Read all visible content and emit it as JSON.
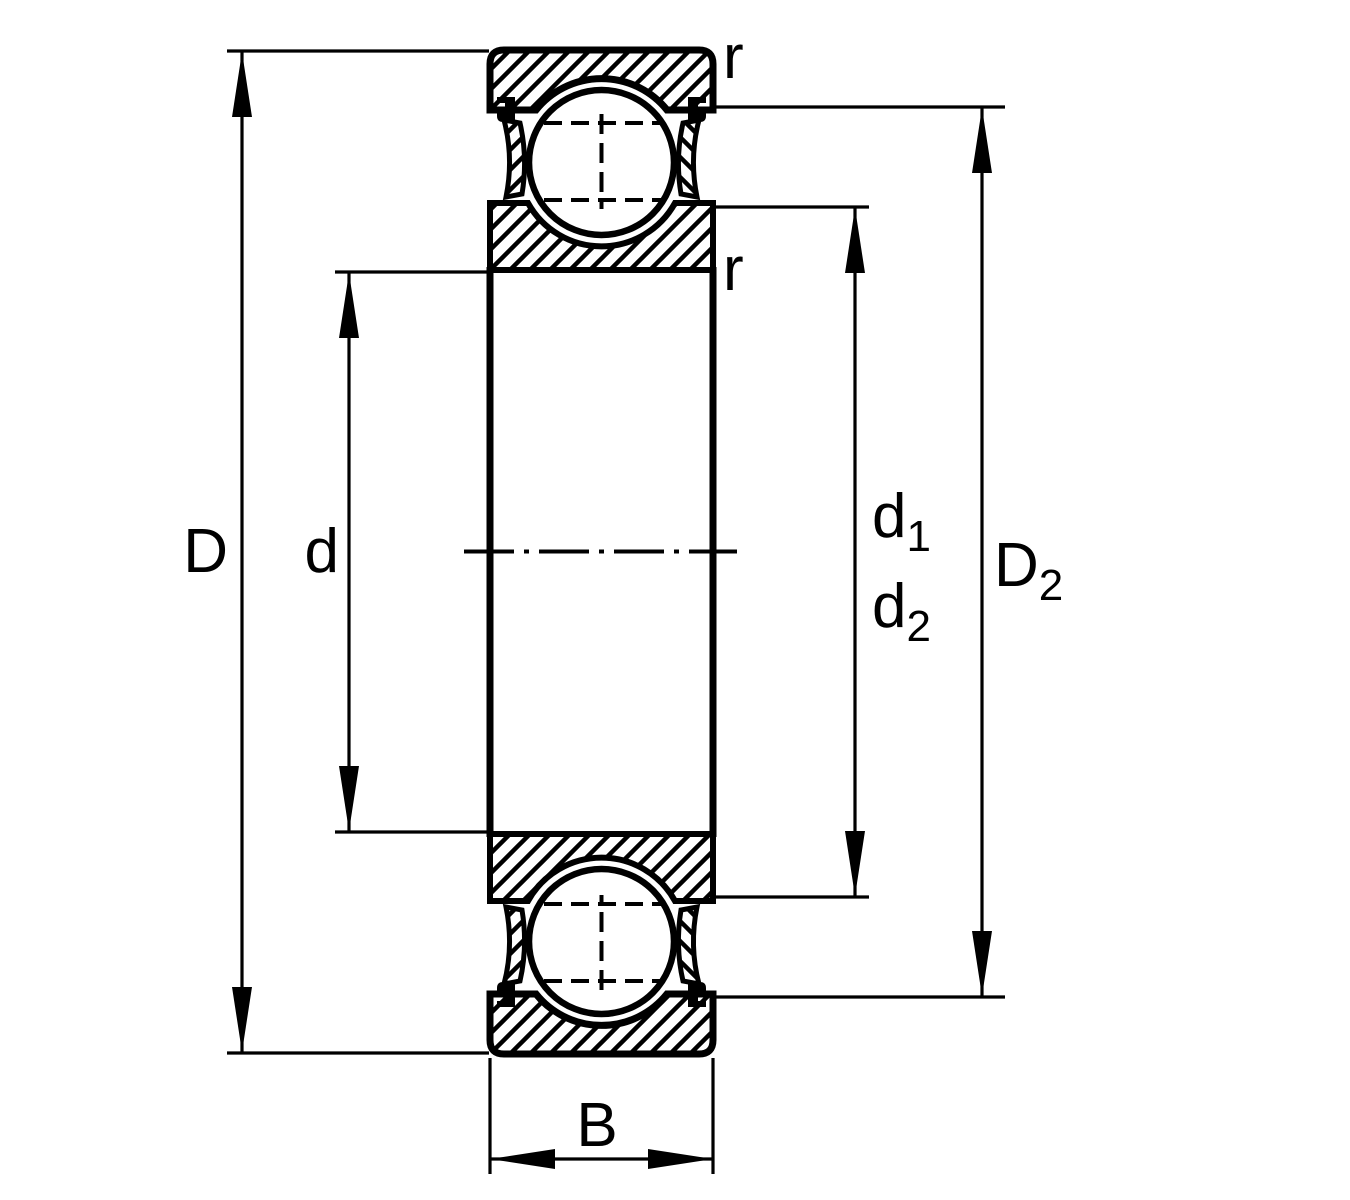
{
  "figure": {
    "background_color": "#ffffff",
    "line_color": "#000000",
    "labels": {
      "outer_diameter": "D",
      "bore_diameter": "d",
      "inner_shoulder_diameter": {
        "main": "d",
        "sub": "1"
      },
      "outer_shoulder_diameter": {
        "main": "d",
        "sub": "2"
      },
      "recess_diameter": {
        "main": "D",
        "sub": "2"
      },
      "width": "B",
      "chamfer_radius_outer": "r",
      "chamfer_radius_inner": "r"
    }
  }
}
